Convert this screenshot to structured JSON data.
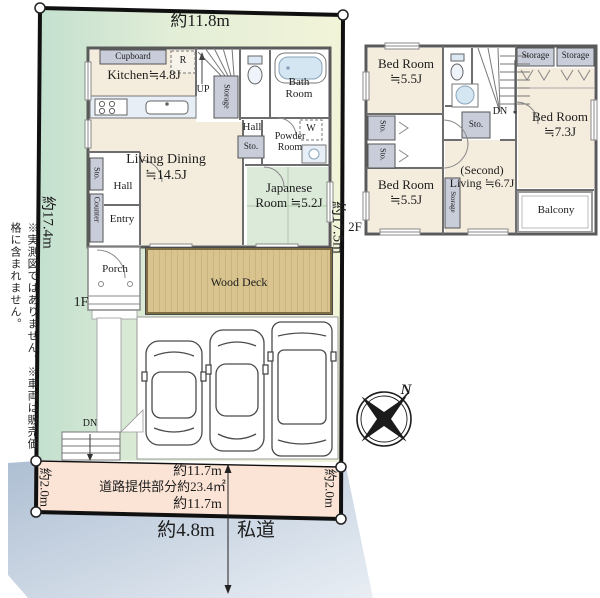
{
  "dims": {
    "top": "約11.8m",
    "left": "約17.4m",
    "right": "約17.5m",
    "strip_top": "約11.7m",
    "strip_area": "道路提供部分約23.4㎡",
    "strip_bottom": "約11.7m",
    "strip_left": "約2.0m",
    "strip_right": "約2.0m",
    "road_width": "約4.8m",
    "road_name": "私道"
  },
  "notes": {
    "line1": "※実測図ではありません。",
    "line2": "※車両は販売価格に含まれません。"
  },
  "f1": {
    "label": "1F",
    "kitchen": "Kitchen≒4.8J",
    "cupboard": "Cupboard",
    "fridge": "R",
    "up": "UP",
    "storage_stairs": "Storage",
    "bath": "Bath Room",
    "hall_upper": "Hall",
    "washer": "W",
    "powder": "Powder Room",
    "sto_powder": "Sto.",
    "living": "Living Dining ≒14.5J",
    "japanese": "Japanese Room ≒5.2J",
    "sto_entry": "Sto.",
    "hall_lower": "Hall",
    "counter": "Counter",
    "entry": "Entry",
    "porch": "Porch",
    "wood_deck": "Wood Deck",
    "dn_site": "DN"
  },
  "f2": {
    "label": "2F",
    "bed1": "Bed Room ≒5.5J",
    "bed2": "Bed Room ≒7.3J",
    "bed3": "Bed Room ≒5.5J",
    "second_living": "(Second) Living ≒6.7J",
    "balcony": "Balcony",
    "storage_a": "Storage",
    "storage_b": "Storage",
    "sto_mid": "Sto.",
    "sto_a": "Sto.",
    "sto_b": "Sto.",
    "storage_vert": "Storage",
    "dn": "DN"
  },
  "compass": {
    "north": "N"
  },
  "colors": {
    "site_green": "#c9e3d2",
    "site_yellow": "#f1f4d8",
    "road_blue": "#b4c3d5",
    "strip_pink": "#fbe4d6",
    "floor_cream": "#f4ecdc",
    "tatami_green": "#dcead9",
    "fixture_blue": "#d6e7f3",
    "closet_gray": "#c9cdda"
  }
}
